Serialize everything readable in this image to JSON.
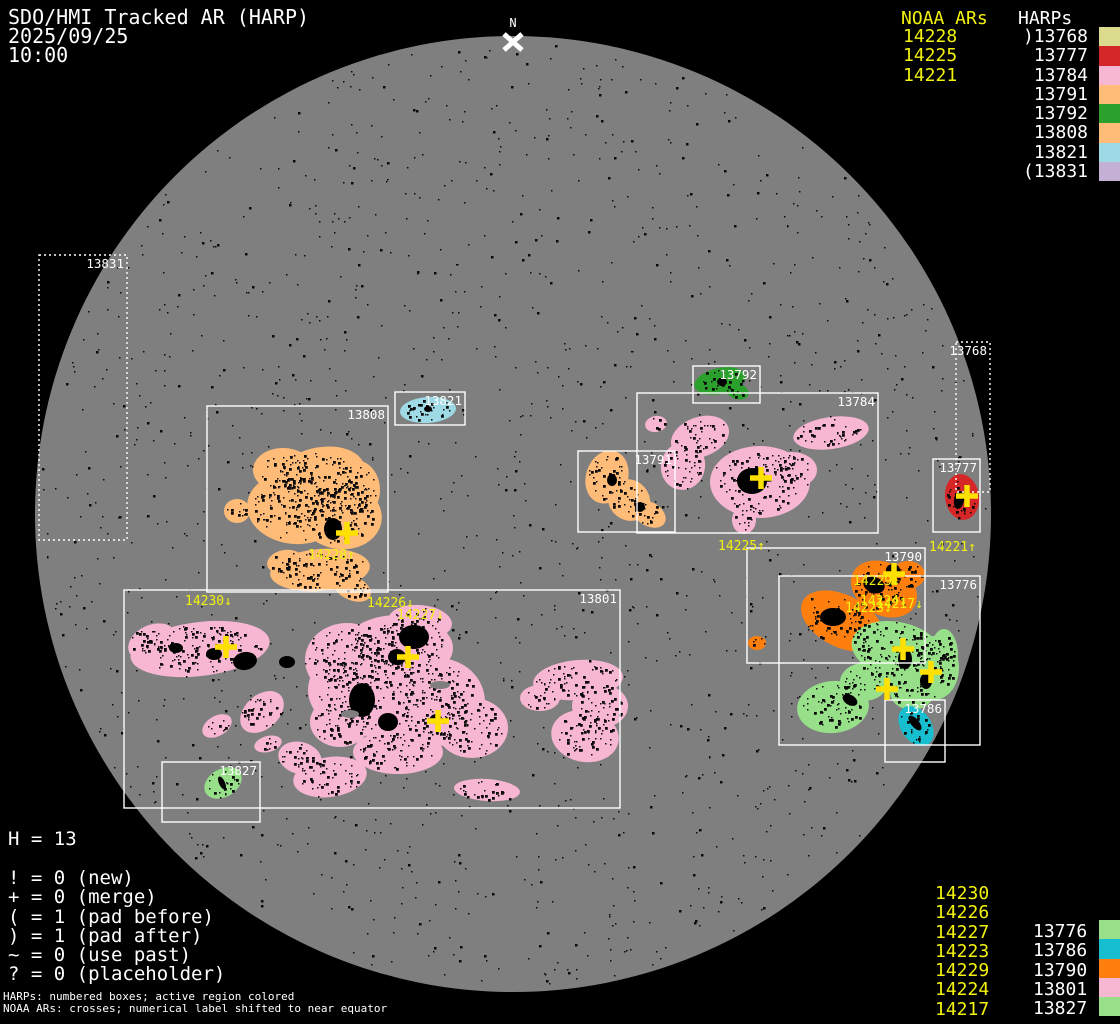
{
  "header": {
    "title": "SDO/HMI Tracked AR (HARP)",
    "date": "2025/09/25",
    "time": "10:00"
  },
  "colors": {
    "background": "#000000",
    "disk": "#7f7f7f",
    "accent_yellow": "#f2f20e",
    "cross_yellow": "#ffe000",
    "box_stroke": "#ffffff"
  },
  "legend_top": {
    "noaa_header": "NOAA ARs",
    "harp_header": "HARPs",
    "noaa": [
      "14228",
      "14225",
      "14221"
    ],
    "harps": [
      {
        "label": ")13768",
        "color": "#dbdb8d"
      },
      {
        "label": "13777",
        "color": "#d62728"
      },
      {
        "label": "13784",
        "color": "#f7b6d2"
      },
      {
        "label": "13791",
        "color": "#ffbb78"
      },
      {
        "label": "13792",
        "color": "#2ca02c"
      },
      {
        "label": "13808",
        "color": "#ffbb78"
      },
      {
        "label": "13821",
        "color": "#9edae5"
      },
      {
        "label": "(13831",
        "color": "#c5b0d5"
      }
    ]
  },
  "legend_bottom": {
    "noaa": [
      "14230",
      "14226",
      "14227",
      "14223",
      "14229",
      "14224",
      "14217"
    ],
    "harps": [
      {
        "label": "13776",
        "color": "#98df8a"
      },
      {
        "label": "13786",
        "color": "#17becf"
      },
      {
        "label": "13790",
        "color": "#ff7f0e"
      },
      {
        "label": "13801",
        "color": "#f7b6d2"
      },
      {
        "label": "13827",
        "color": "#98df8a"
      }
    ]
  },
  "stats": {
    "h_count": "H = 13"
  },
  "flags": [
    "! = 0 (new)",
    "+ = 0 (merge)",
    "( = 1 (pad before)",
    ") = 1 (pad after)",
    "~ = 0 (use past)",
    "? = 0 (placeholder)"
  ],
  "footnotes": [
    "HARPs: numbered boxes; active region colored",
    "NOAA ARs: crosses; numerical label shifted to near equator"
  ],
  "chart_data": {
    "type": "scatter",
    "title": "SDO/HMI Tracked AR (HARP) 2025/09/25 10:00",
    "harp_count": 13,
    "harps": [
      {
        "id": "13768",
        "color": "#dbdb8d",
        "flag": "pad after",
        "box": [
          956,
          342,
          34,
          150
        ],
        "dotted": true
      },
      {
        "id": "13777",
        "color": "#d62728",
        "box": [
          933,
          459,
          47,
          73
        ]
      },
      {
        "id": "13784",
        "color": "#f7b6d2",
        "box": [
          637,
          393,
          241,
          140
        ]
      },
      {
        "id": "13791",
        "color": "#ffbb78",
        "box": [
          578,
          451,
          97,
          81
        ]
      },
      {
        "id": "13792",
        "color": "#2ca02c",
        "box": [
          693,
          366,
          67,
          37
        ]
      },
      {
        "id": "13808",
        "color": "#ffbb78",
        "box": [
          207,
          406,
          181,
          186
        ]
      },
      {
        "id": "13821",
        "color": "#9edae5",
        "box": [
          395,
          392,
          70,
          33
        ]
      },
      {
        "id": "13831",
        "color": "#c5b0d5",
        "flag": "pad before",
        "box": [
          39,
          255,
          88,
          285
        ],
        "dotted": true
      },
      {
        "id": "13776",
        "color": "#98df8a",
        "box": [
          779,
          576,
          201,
          169
        ]
      },
      {
        "id": "13786",
        "color": "#17becf",
        "box": [
          885,
          700,
          60,
          62
        ]
      },
      {
        "id": "13790",
        "color": "#ff7f0e",
        "box": [
          747,
          548,
          178,
          115
        ]
      },
      {
        "id": "13801",
        "color": "#f7b6d2",
        "box": [
          124,
          590,
          496,
          218
        ]
      },
      {
        "id": "13827",
        "color": "#98df8a",
        "box": [
          162,
          762,
          98,
          60
        ]
      }
    ],
    "noaa_crosses": [
      [
        347,
        533
      ],
      [
        226,
        647
      ],
      [
        408,
        657
      ],
      [
        438,
        721
      ],
      [
        761,
        478
      ],
      [
        967,
        496
      ],
      [
        894,
        574
      ],
      [
        903,
        649
      ],
      [
        931,
        672
      ],
      [
        887,
        689
      ]
    ]
  },
  "scene": {
    "disk": {
      "cx": 513,
      "cy": 514,
      "r": 478,
      "color": "#7f7f7f"
    },
    "north": {
      "label": "N",
      "x": 513,
      "y": 27,
      "cx": 513,
      "cy": 42
    },
    "speckle_seed": 123457,
    "speckle_count": 1600,
    "boxes": [
      {
        "id": "13831",
        "x": 39,
        "y": 255,
        "w": 88,
        "h": 285,
        "dotted": true
      },
      {
        "id": "13808",
        "x": 207,
        "y": 406,
        "w": 181,
        "h": 186,
        "dotted": false
      },
      {
        "id": "13821",
        "x": 395,
        "y": 392,
        "w": 70,
        "h": 33,
        "dotted": false
      },
      {
        "id": "13801",
        "x": 124,
        "y": 590,
        "w": 496,
        "h": 218,
        "dotted": false
      },
      {
        "id": "13827",
        "x": 162,
        "y": 762,
        "w": 98,
        "h": 60,
        "dotted": false
      },
      {
        "id": "13792",
        "x": 693,
        "y": 366,
        "w": 67,
        "h": 37,
        "dotted": false
      },
      {
        "id": "13784",
        "x": 637,
        "y": 393,
        "w": 241,
        "h": 140,
        "dotted": false
      },
      {
        "id": "13791",
        "x": 578,
        "y": 451,
        "w": 97,
        "h": 81,
        "dotted": false
      },
      {
        "id": "13768",
        "x": 956,
        "y": 342,
        "w": 34,
        "h": 150,
        "dotted": true
      },
      {
        "id": "13777",
        "x": 933,
        "y": 459,
        "w": 47,
        "h": 73,
        "dotted": false
      },
      {
        "id": "13790",
        "x": 747,
        "y": 548,
        "w": 178,
        "h": 115,
        "dotted": false
      },
      {
        "id": "13776",
        "x": 779,
        "y": 576,
        "w": 201,
        "h": 169,
        "dotted": false
      },
      {
        "id": "13786",
        "x": 885,
        "y": 700,
        "w": 60,
        "h": 62,
        "dotted": false
      }
    ],
    "regions": [
      {
        "harp": "13808",
        "color": "#ffbb78",
        "ellipses": [
          [
            318,
            478,
            48,
            30,
            -15
          ],
          [
            295,
            508,
            48,
            36,
            5
          ],
          [
            340,
            515,
            42,
            34,
            10
          ],
          [
            283,
            470,
            30,
            22,
            0
          ],
          [
            355,
            490,
            25,
            30,
            0
          ],
          [
            237,
            511,
            13,
            12,
            0
          ],
          [
            320,
            570,
            50,
            21,
            -5
          ],
          [
            352,
            588,
            20,
            12,
            25
          ],
          [
            285,
            562,
            18,
            12,
            -10
          ]
        ]
      },
      {
        "harp": "13801",
        "color": "#f7b6d2",
        "ellipses": [
          [
            200,
            649,
            70,
            27,
            -7
          ],
          [
            152,
            642,
            25,
            17,
            -25
          ],
          [
            262,
            712,
            25,
            17,
            -42
          ],
          [
            217,
            726,
            16,
            10,
            -30
          ],
          [
            268,
            744,
            14,
            8,
            -15
          ],
          [
            398,
            648,
            55,
            33,
            0
          ],
          [
            370,
            690,
            62,
            46,
            0
          ],
          [
            438,
            702,
            47,
            44,
            0
          ],
          [
            347,
            660,
            42,
            37,
            0
          ],
          [
            420,
            622,
            32,
            17,
            5
          ],
          [
            472,
            728,
            36,
            30,
            0
          ],
          [
            398,
            752,
            45,
            22,
            0
          ],
          [
            340,
            722,
            30,
            25,
            0
          ],
          [
            578,
            680,
            45,
            20,
            -5
          ],
          [
            600,
            706,
            28,
            22,
            0
          ],
          [
            585,
            736,
            34,
            26,
            10
          ],
          [
            540,
            698,
            20,
            13,
            0
          ],
          [
            487,
            790,
            33,
            11,
            4
          ],
          [
            330,
            777,
            37,
            20,
            -8
          ],
          [
            300,
            758,
            22,
            16,
            15
          ]
        ]
      },
      {
        "harp": "13827",
        "color": "#98df8a",
        "ellipses": [
          [
            223,
            783,
            20,
            14,
            -30
          ]
        ]
      },
      {
        "harp": "13784",
        "color": "#f7b6d2",
        "ellipses": [
          [
            700,
            437,
            30,
            20,
            -20
          ],
          [
            683,
            466,
            22,
            24,
            15
          ],
          [
            760,
            482,
            50,
            36,
            0
          ],
          [
            831,
            433,
            38,
            16,
            -8
          ],
          [
            656,
            424,
            11,
            8,
            -10
          ],
          [
            744,
            520,
            12,
            14,
            0
          ],
          [
            792,
            470,
            25,
            18,
            0
          ]
        ]
      },
      {
        "harp": "13791",
        "color": "#ffbb78",
        "ellipses": [
          [
            607,
            477,
            21,
            27,
            18
          ],
          [
            629,
            500,
            22,
            20,
            40
          ],
          [
            649,
            514,
            18,
            12,
            30
          ]
        ]
      },
      {
        "harp": "13792",
        "color": "#2ca02c",
        "ellipses": [
          [
            720,
            381,
            26,
            13,
            -12
          ],
          [
            737,
            391,
            12,
            8,
            20
          ]
        ]
      },
      {
        "harp": "13821",
        "color": "#9edae5",
        "ellipses": [
          [
            428,
            410,
            28,
            13,
            -4
          ]
        ]
      },
      {
        "harp": "13777",
        "color": "#d62728",
        "ellipses": [
          [
            962,
            497,
            17,
            23,
            -8
          ]
        ]
      },
      {
        "harp": "13790",
        "color": "#ff7f0e",
        "ellipses": [
          [
            842,
            621,
            44,
            26,
            27
          ],
          [
            884,
            589,
            35,
            26,
            30
          ],
          [
            908,
            575,
            17,
            14,
            0
          ],
          [
            757,
            643,
            9,
            7,
            0
          ]
        ]
      },
      {
        "harp": "13776",
        "color": "#98df8a",
        "ellipses": [
          [
            897,
            650,
            46,
            28,
            12
          ],
          [
            934,
            668,
            25,
            32,
            0
          ],
          [
            864,
            682,
            24,
            19,
            0
          ],
          [
            833,
            707,
            36,
            26,
            -6
          ],
          [
            912,
            692,
            22,
            18,
            0
          ],
          [
            944,
            655,
            14,
            26,
            0
          ],
          [
            888,
            672,
            20,
            15,
            0
          ]
        ]
      },
      {
        "harp": "13786",
        "color": "#17becf",
        "ellipses": [
          [
            916,
            726,
            15,
            22,
            -35
          ]
        ]
      }
    ],
    "cores": [
      [
        414,
        637,
        15,
        12,
        0
      ],
      [
        397,
        657,
        9,
        8,
        0
      ],
      [
        245,
        661,
        12,
        9,
        -10
      ],
      [
        214,
        654,
        8,
        6,
        0
      ],
      [
        436,
        719,
        6,
        5,
        0
      ],
      [
        362,
        700,
        13,
        17,
        0
      ],
      [
        388,
        722,
        10,
        9,
        0
      ],
      [
        333,
        529,
        9,
        11,
        0
      ],
      [
        752,
        481,
        15,
        13,
        0
      ],
      [
        874,
        585,
        11,
        8,
        20
      ],
      [
        833,
        617,
        13,
        9,
        0
      ],
      [
        893,
        570,
        7,
        6,
        0
      ],
      [
        905,
        659,
        7,
        10,
        0
      ],
      [
        926,
        681,
        6,
        8,
        0
      ],
      [
        850,
        700,
        8,
        5,
        30
      ],
      [
        959,
        500,
        5,
        9,
        10
      ],
      [
        915,
        723,
        4,
        9,
        -40
      ],
      [
        222,
        783,
        3,
        7,
        -25
      ],
      [
        428,
        409,
        4,
        3,
        0
      ],
      [
        722,
        382,
        5,
        4,
        0
      ],
      [
        612,
        480,
        5,
        6,
        0
      ],
      [
        640,
        507,
        5,
        5,
        0
      ],
      [
        287,
        662,
        8,
        6,
        0
      ],
      [
        176,
        648,
        7,
        5,
        0
      ]
    ],
    "holes": [
      [
        440,
        685,
        10,
        4,
        0
      ],
      [
        350,
        714,
        9,
        4,
        0
      ]
    ],
    "crosses": [
      [
        347,
        533
      ],
      [
        226,
        647
      ],
      [
        408,
        657
      ],
      [
        438,
        721
      ],
      [
        761,
        478
      ],
      [
        967,
        496
      ],
      [
        894,
        574
      ],
      [
        903,
        649
      ],
      [
        931,
        672
      ],
      [
        887,
        689
      ]
    ],
    "ar_labels": [
      {
        "text": "14228↑",
        "x": 308,
        "y": 549
      },
      {
        "text": "14230↓",
        "x": 185,
        "y": 595
      },
      {
        "text": "14226↓",
        "x": 367,
        "y": 597
      },
      {
        "text": "14227↓",
        "x": 397,
        "y": 609
      },
      {
        "text": "14225↑",
        "x": 718,
        "y": 540
      },
      {
        "text": "14221↑",
        "x": 929,
        "y": 541
      },
      {
        "text": "14229↓",
        "x": 853,
        "y": 575
      },
      {
        "text": "14217↓",
        "x": 876,
        "y": 598
      },
      {
        "text": "14224↓",
        "x": 860,
        "y": 595
      },
      {
        "text": "14223↓",
        "x": 845,
        "y": 602
      }
    ]
  }
}
